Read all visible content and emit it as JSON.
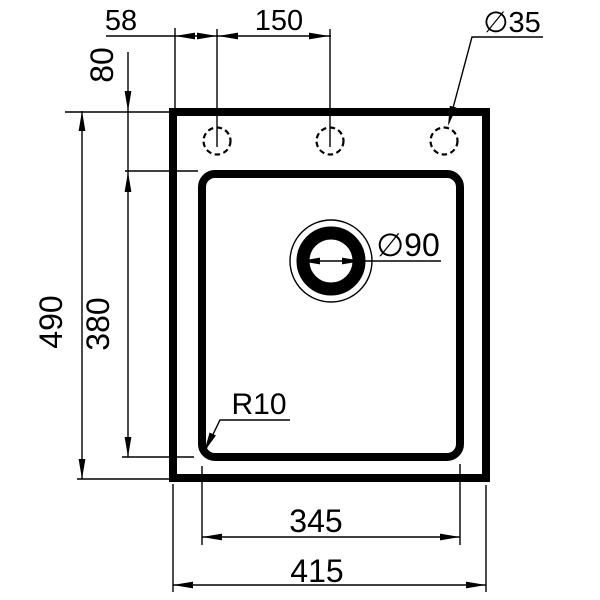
{
  "labels": {
    "hole_offset_left": "58",
    "hole_spacing": "150",
    "hole_diameter": "∅35",
    "hole_offset_top": "80",
    "overall_height": "490",
    "bowl_height": "380",
    "drain_diameter": "∅90",
    "corner_radius": "R10",
    "bowl_width": "345",
    "overall_width": "415"
  },
  "colors": {
    "line": "#000000",
    "background": "#ffffff"
  }
}
